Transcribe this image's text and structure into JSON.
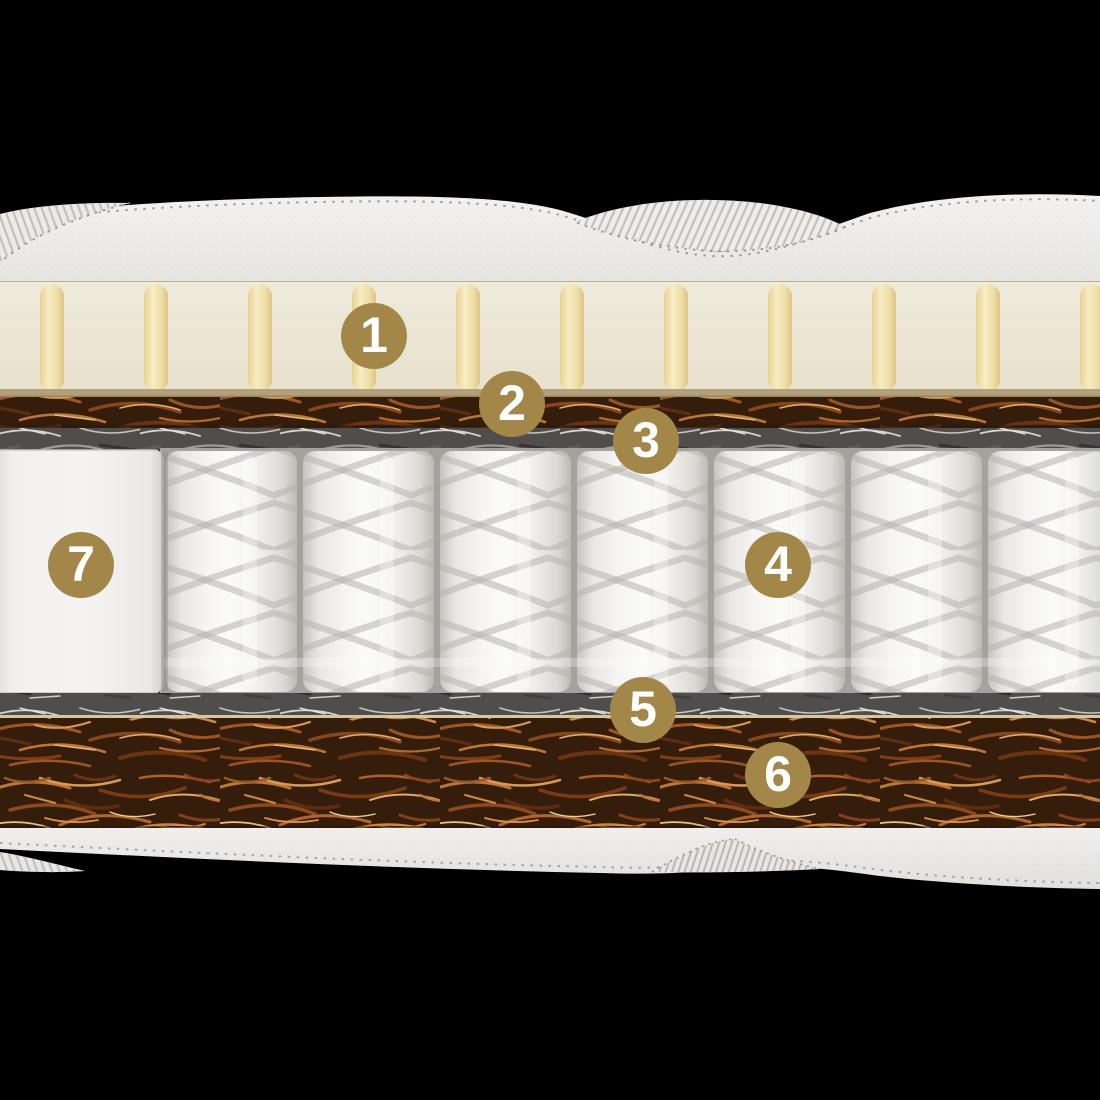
{
  "diagram": {
    "type": "mattress-cross-section",
    "markers": [
      {
        "label": "1"
      },
      {
        "label": "2"
      },
      {
        "label": "3"
      },
      {
        "label": "4"
      },
      {
        "label": "5"
      },
      {
        "label": "6"
      },
      {
        "label": "7"
      }
    ],
    "colors": {
      "background": "#000000",
      "marker_fill": "#a28748",
      "marker_text": "#ffffff",
      "quilted_cover": "#efedea",
      "latex_layer": "#ebe6d4",
      "latex_pin": "#f0dfa8",
      "coconut_coir": "#8a4a22",
      "felt_layer": "#504e4c",
      "pocket_spring": "#f3f2ef"
    }
  }
}
